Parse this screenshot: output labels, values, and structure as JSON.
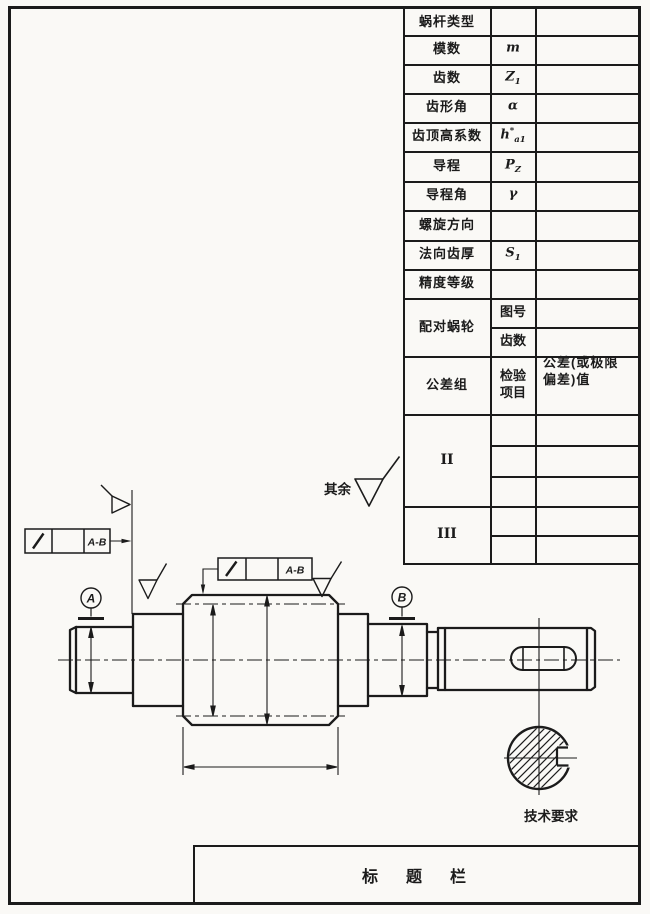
{
  "colors": {
    "paper": "#faf9f6",
    "ink": "#1b1b1b"
  },
  "param_table": {
    "rows": [
      {
        "label": "蜗杆类型"
      },
      {
        "label": "模数",
        "sym": {
          "base": "m"
        }
      },
      {
        "label": "齿数",
        "sym": {
          "base": "Z",
          "sub": "1"
        }
      },
      {
        "label": "齿形角",
        "sym": {
          "base": "α"
        }
      },
      {
        "label": "齿顶高系数",
        "sym": {
          "base": "h",
          "sup": "*",
          "sub": "a1"
        }
      },
      {
        "label": "导程",
        "sym": {
          "base": "P",
          "sub": "Z"
        }
      },
      {
        "label": "导程角",
        "sym": {
          "base": "γ"
        }
      },
      {
        "label": "螺旋方向"
      },
      {
        "label": "法向齿厚",
        "sym": {
          "base": "S",
          "sub": "1"
        }
      },
      {
        "label": "精度等级"
      }
    ],
    "mating": {
      "label": "配对蜗轮",
      "sub_rows": [
        "图号",
        "齿数"
      ]
    },
    "tolerance": {
      "group_header": "公差组",
      "check_header_line1": "检验",
      "check_header_line2": "项目",
      "value_header_line1": "公差(或极限",
      "value_header_line2": "偏差)值",
      "groups": [
        "II",
        "III"
      ]
    }
  },
  "annotations": {
    "rest_roughness_label": "其余",
    "tech_requirements": "技术要求",
    "title_bar": "标　题　栏",
    "datum_a": "A",
    "datum_b": "B",
    "runout_datum_ref": "A-B"
  }
}
